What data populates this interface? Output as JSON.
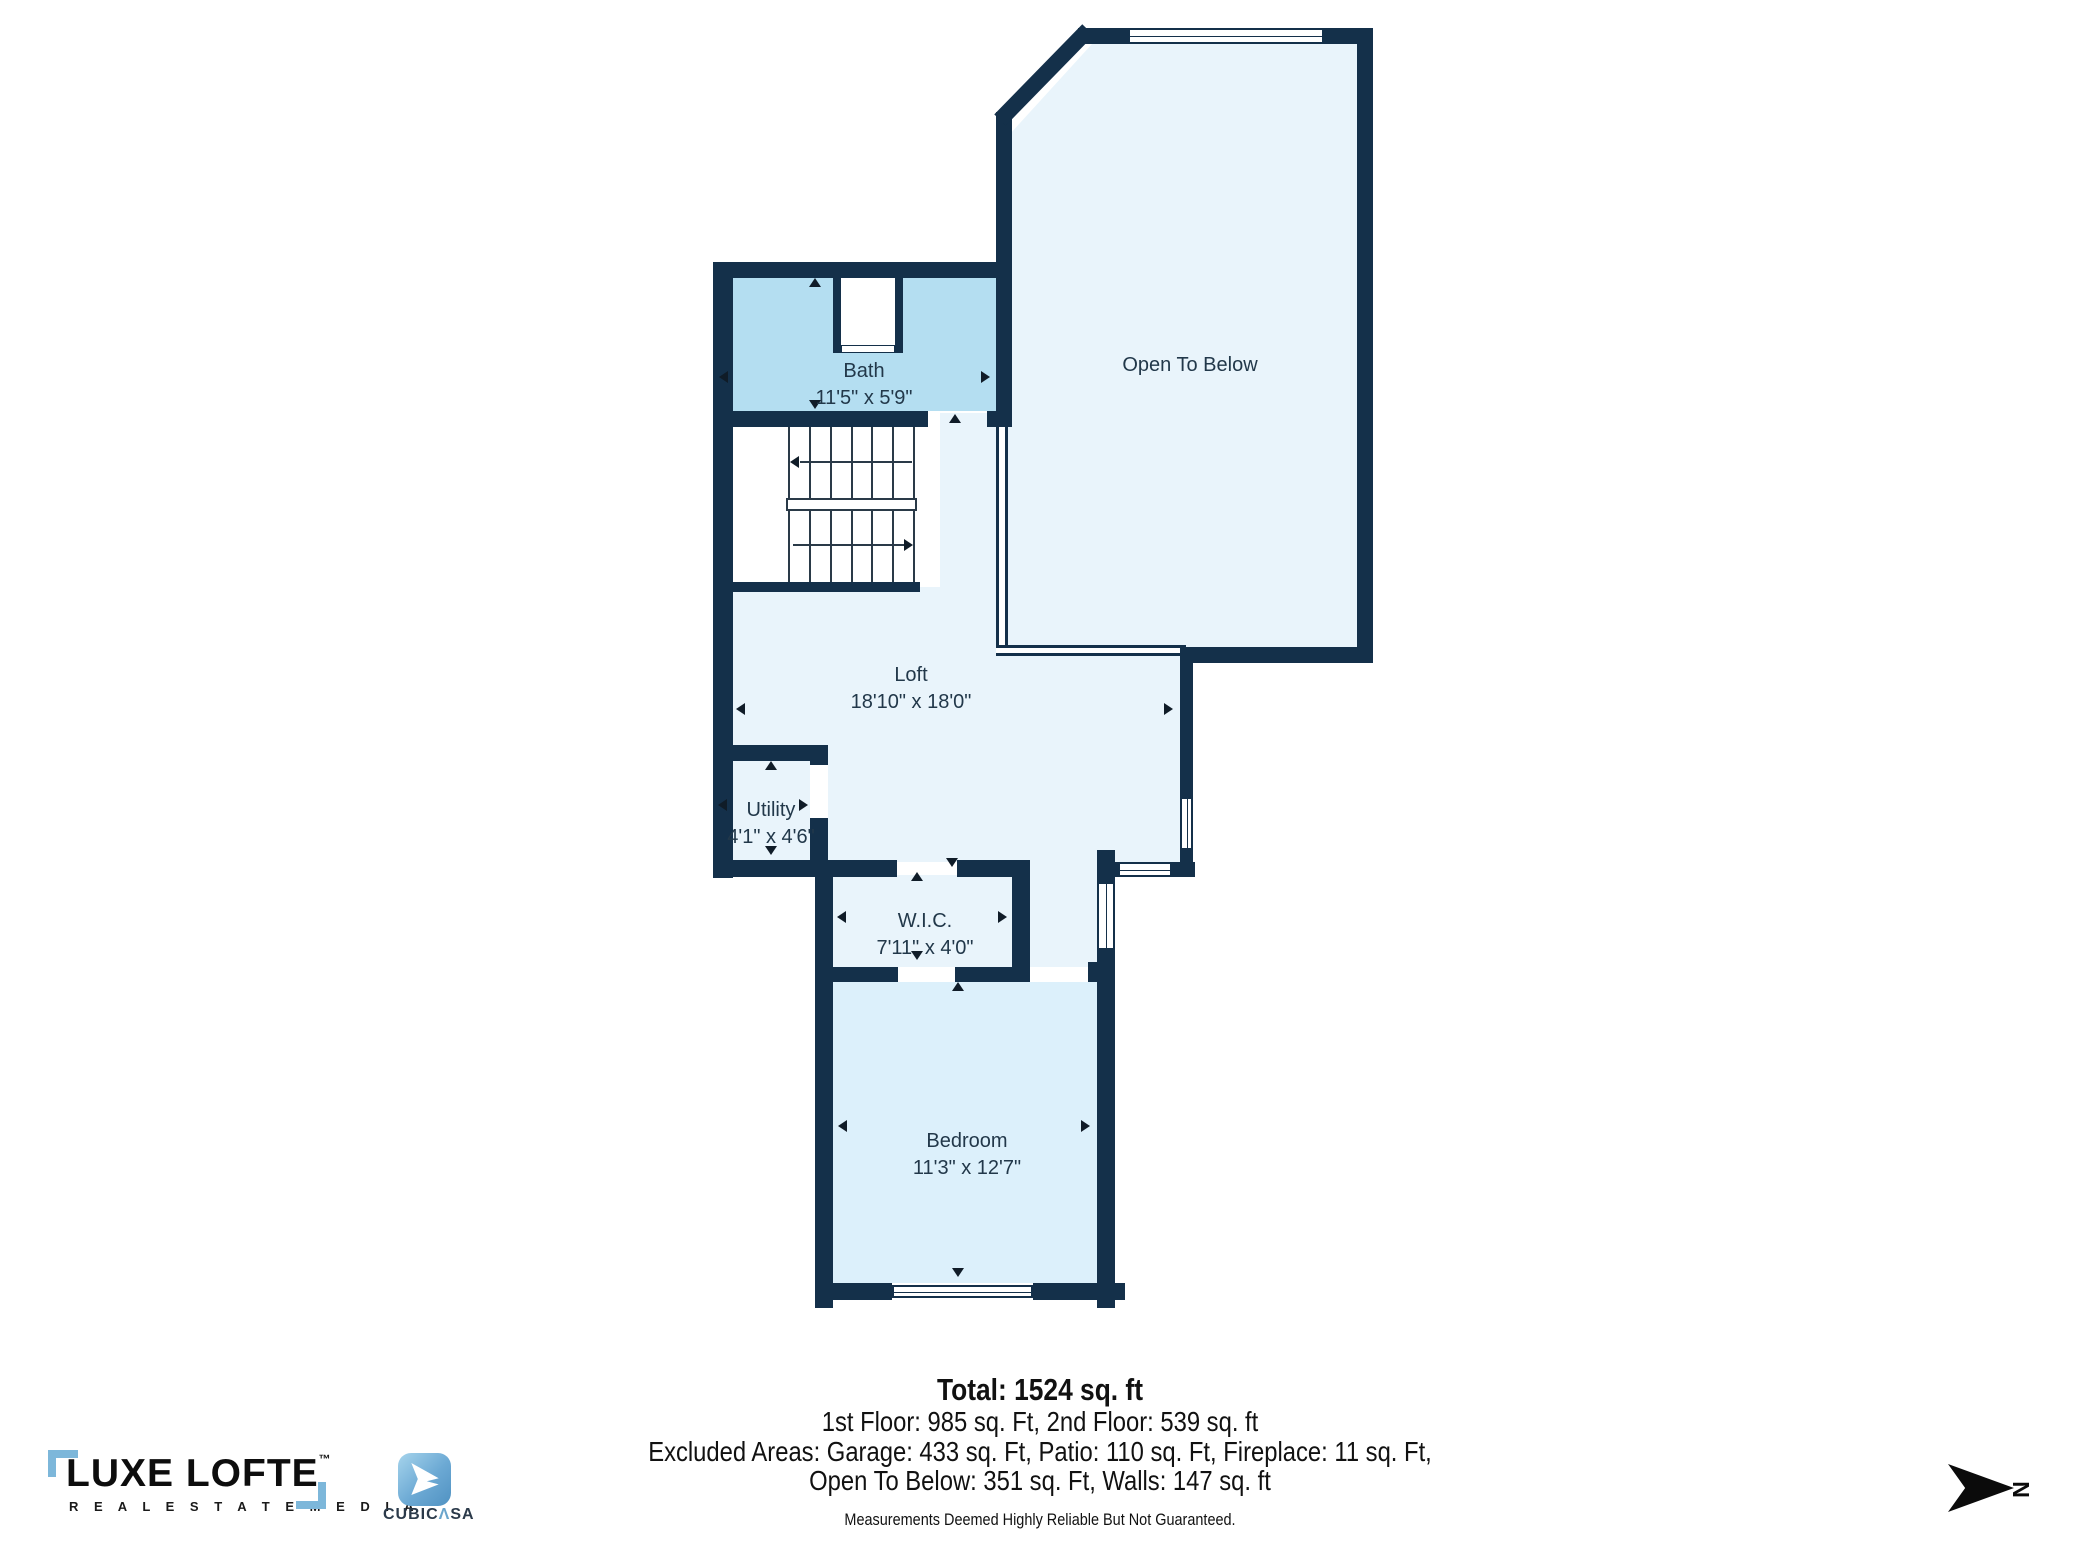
{
  "plan": {
    "rooms": {
      "bath": {
        "name": "Bath",
        "dims": "11'5\" x 5'9\""
      },
      "open_to_below": {
        "name": "Open To Below",
        "dims": ""
      },
      "loft": {
        "name": "Loft",
        "dims": "18'10\" x 18'0\""
      },
      "utility": {
        "name": "Utility",
        "dims": "4'1\" x 4'6\""
      },
      "wic": {
        "name": "W.I.C.",
        "dims": "7'11\" x 4'0\""
      },
      "bedroom": {
        "name": "Bedroom",
        "dims": "11'3\" x 12'7\""
      }
    },
    "compass": {
      "label": "N"
    },
    "colors": {
      "wall": "#14304a",
      "room_pale": "#e9f4fb",
      "room_bath": "#b4def1",
      "room_bedroom": "#dcf0fb"
    }
  },
  "summary": {
    "total": "Total: 1524 sq. ft",
    "floors": "1st Floor: 985 sq. Ft, 2nd Floor: 539 sq. ft",
    "excluded1": "Excluded Areas: Garage: 433 sq. Ft, Patio: 110 sq. Ft, Fireplace: 11 sq. Ft,",
    "excluded2": "Open To Below: 351 sq. Ft, Walls: 147 sq. ft",
    "disclaimer": "Measurements Deemed Highly Reliable But Not Guaranteed."
  },
  "branding": {
    "luxe": {
      "name": "LUXE LOFTE",
      "tm": "™",
      "tagline": "R E A L   E S T A T E   M E D I A"
    },
    "cubicasa": {
      "pre": "CUBIC",
      "caret": "Λ",
      "post": "SA"
    }
  }
}
